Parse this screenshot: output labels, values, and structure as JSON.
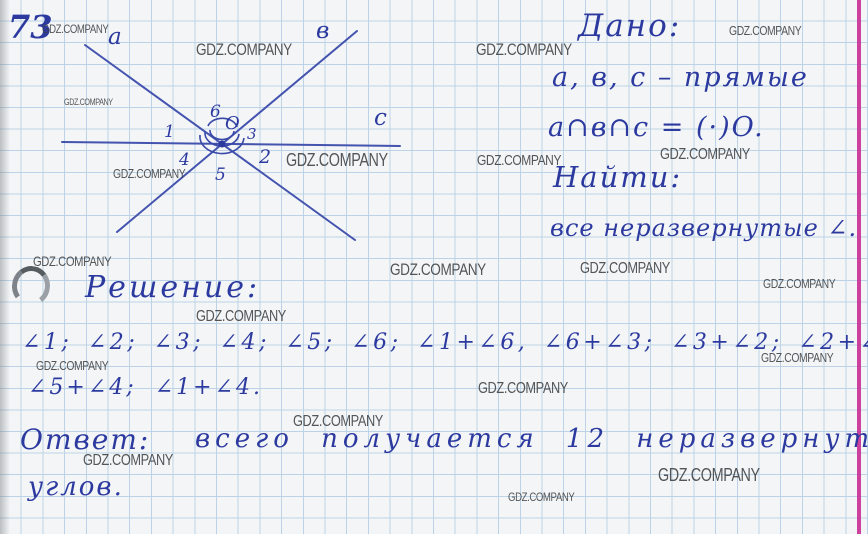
{
  "page": {
    "problem_number": "73",
    "watermark_text": "GDZ.COMPANY",
    "colors": {
      "ink": "#2c3aa0",
      "figure_line": "#4353ae",
      "grid": "#bcd2e6",
      "margin_line": "#c92d93",
      "watermark": "#3d3f41",
      "paper": "#f3f5f7"
    }
  },
  "figure": {
    "description": "three lines a, b, c crossing at one point O, angles 1-6 marked with arcs",
    "line_labels": [
      "a",
      "в",
      "c"
    ],
    "point_label": "O",
    "angle_labels": [
      "1",
      "2",
      "3",
      "4",
      "5",
      "6"
    ],
    "labels": [
      {
        "text": "a",
        "x": 58,
        "y": 22,
        "size": 23
      },
      {
        "text": "в",
        "x": 266,
        "y": 16,
        "size": 23
      },
      {
        "text": "c",
        "x": 324,
        "y": 103,
        "size": 23
      },
      {
        "text": "O",
        "x": 175,
        "y": 107,
        "size": 18
      },
      {
        "text": "1",
        "x": 114,
        "y": 115,
        "size": 17
      },
      {
        "text": "6",
        "x": 160,
        "y": 95,
        "size": 17
      },
      {
        "text": "3",
        "x": 197,
        "y": 117,
        "size": 15
      },
      {
        "text": "4",
        "x": 129,
        "y": 143,
        "size": 17
      },
      {
        "text": "5",
        "x": 165,
        "y": 158,
        "size": 17
      },
      {
        "text": "2",
        "x": 209,
        "y": 141,
        "size": 19
      }
    ]
  },
  "given": {
    "heading": "Дано:",
    "line1": "а, в, с – прямые",
    "line2": "а∩в∩с = (·)O."
  },
  "find": {
    "heading": "Найти:",
    "line1": "все неразвернутые ∠."
  },
  "solution": {
    "heading": "Решение:",
    "line1": "∠1; ∠2; ∠3; ∠4; ∠5; ∠6; ∠1+∠6, ∠6+∠3; ∠3+∠2; ∠2+∠5;",
    "line2": "∠5+∠4; ∠1+∠4."
  },
  "answer": {
    "heading": "Ответ:",
    "text": "всего получается 12 неразвернутых",
    "text2": "углов."
  },
  "watermarks": [
    {
      "x": 42,
      "y": 22,
      "s": 12
    },
    {
      "x": 196,
      "y": 40,
      "s": 17
    },
    {
      "x": 64,
      "y": 97,
      "s": 9
    },
    {
      "x": 113,
      "y": 166,
      "s": 13
    },
    {
      "x": 286,
      "y": 150,
      "s": 18
    },
    {
      "x": 476,
      "y": 40,
      "s": 17
    },
    {
      "x": 729,
      "y": 23,
      "s": 13
    },
    {
      "x": 477,
      "y": 152,
      "s": 15
    },
    {
      "x": 660,
      "y": 146,
      "s": 16
    },
    {
      "x": 33,
      "y": 253,
      "s": 14
    },
    {
      "x": 390,
      "y": 260,
      "s": 17
    },
    {
      "x": 580,
      "y": 260,
      "s": 16
    },
    {
      "x": 763,
      "y": 276,
      "s": 13
    },
    {
      "x": 196,
      "y": 308,
      "s": 16
    },
    {
      "x": 36,
      "y": 358,
      "s": 13
    },
    {
      "x": 761,
      "y": 350,
      "s": 13
    },
    {
      "x": 478,
      "y": 380,
      "s": 16
    },
    {
      "x": 293,
      "y": 413,
      "s": 16
    },
    {
      "x": 83,
      "y": 452,
      "s": 16
    },
    {
      "x": 658,
      "y": 465,
      "s": 18
    },
    {
      "x": 508,
      "y": 490,
      "s": 12
    }
  ]
}
